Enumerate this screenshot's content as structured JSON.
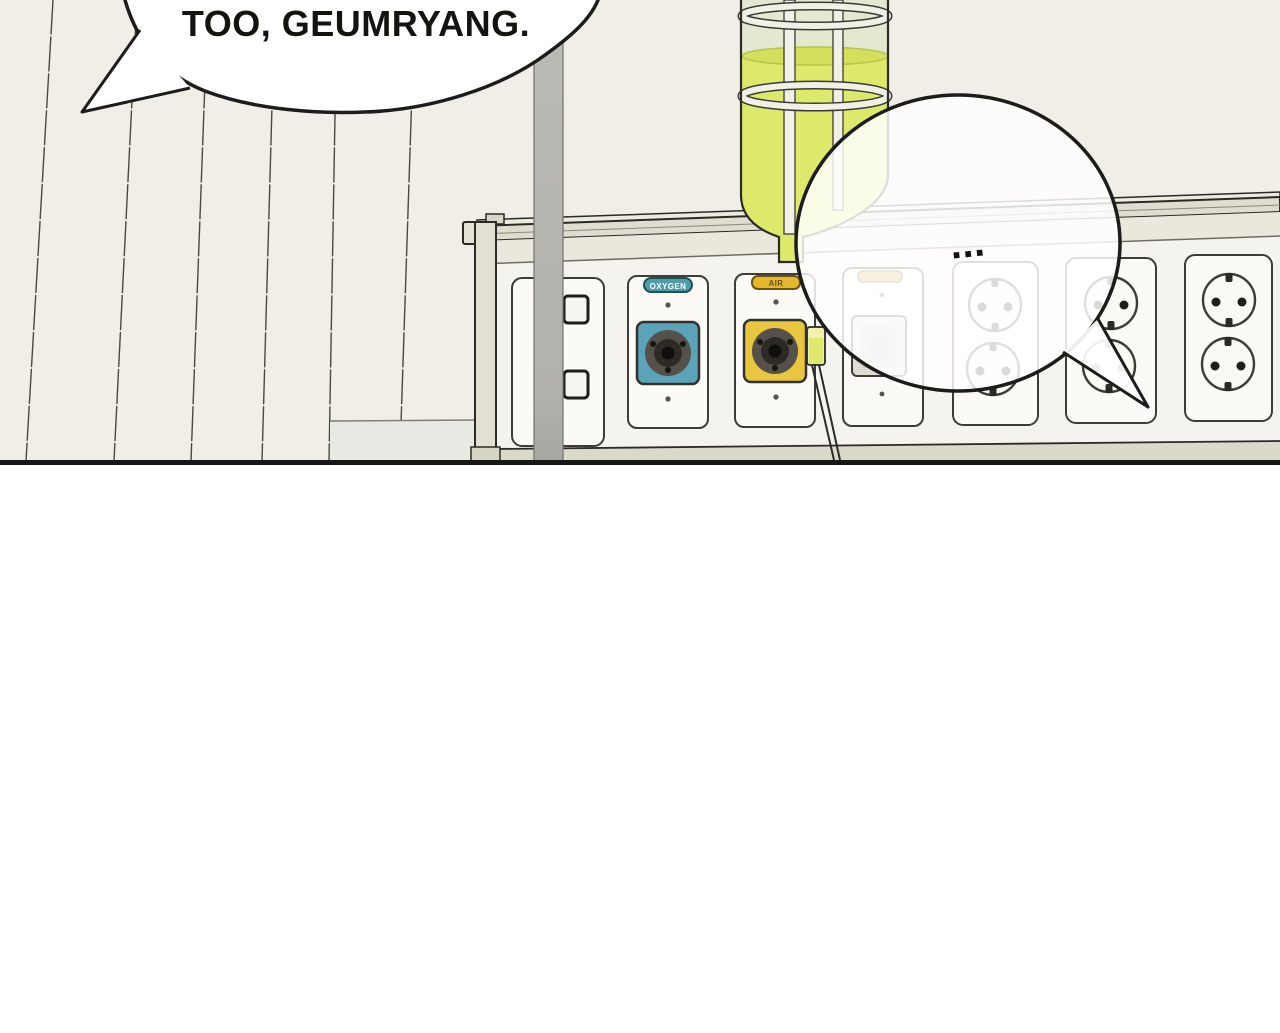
{
  "bubbles": {
    "main": {
      "text": "TOO, GEUMRYANG."
    },
    "ellipsis": {
      "text": "..."
    }
  },
  "panel_labels": {
    "oxygen": "OXYGEN",
    "air": "AIR",
    "ghost": ""
  },
  "colors": {
    "wall": "#f1ede7",
    "gutter": "#ffffff",
    "floor_line": "#161614",
    "liquid": "#dce96b",
    "liquid_surface": "#d2e05c",
    "glass": "#e4e8d0",
    "bottle_band": "#f1f0e7",
    "oxygen_label": "#4f9dab",
    "oxygen_outlet": "#5ba3b8",
    "air_label": "#e3b82f",
    "air_outlet": "#e9c63f",
    "ghost_label": "#d3a93c",
    "pole_top": "#bcbcb6",
    "pole_bottom": "#a8a7a1",
    "console_face": "#f4f3ed",
    "console_trim": "#deddd0",
    "console_band": "#eae8dc",
    "console_base": "#dbd9ca",
    "lower_wall": "#e7e9e2",
    "drip_chamber": "#dfe96e",
    "bubble_fill": "#ffffff",
    "outline": "#1c1c1a"
  }
}
